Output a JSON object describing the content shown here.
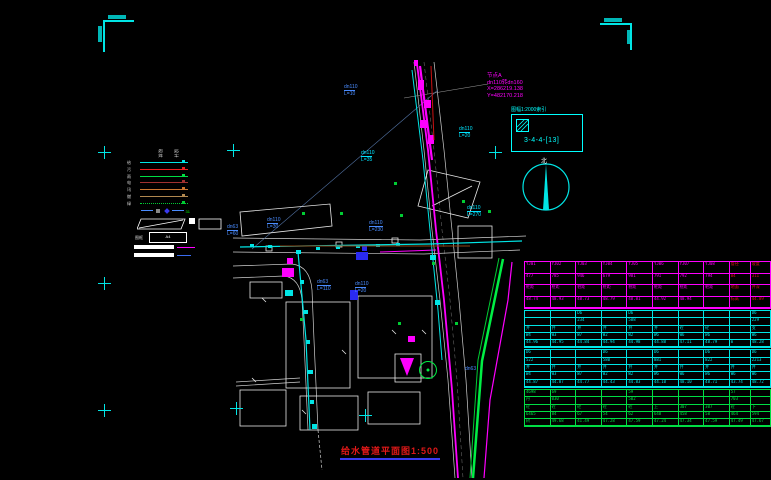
{
  "title": {
    "text": "给水管道平面图1:500"
  },
  "coord_note": {
    "l1": "节点A",
    "l2": "dn110转dn160",
    "l3": "X=286219.138",
    "l4": "Y=482170.218"
  },
  "detail_box": {
    "title": "图幅1:2000索引",
    "code": "3-4-4-[13]"
  },
  "north": {
    "label": "北"
  },
  "colors": {
    "magenta": "#ff00ff",
    "cyan": "#00ffff",
    "green": "#00ee44",
    "red": "#e01818",
    "blue": "#4a8cff",
    "white": "#ffffff"
  },
  "legend": {
    "headers": [
      "现状",
      "设计"
    ],
    "rows": [
      {
        "label": "给",
        "color": "#00e5e5",
        "style": "solid"
      },
      {
        "label": "污",
        "color": "#ee2222",
        "style": "solid"
      },
      {
        "label": "雨",
        "color": "#00dd44",
        "style": "solid"
      },
      {
        "label": "电",
        "color": "#a03030",
        "style": "solid"
      },
      {
        "label": "讯",
        "color": "#cc7630",
        "style": "solid"
      },
      {
        "label": "燃",
        "color": "#b08850",
        "style": "solid"
      },
      {
        "label": "绿",
        "color": "#00cc33",
        "style": "dotted"
      }
    ],
    "symbol_row": {
      "dash_color": "#4a8cff",
      "diamond_color": "#3a3af0",
      "square_color": "#888888",
      "note": "31"
    },
    "frame_label": "图框",
    "a4_label": "A4"
  },
  "annotations": [
    {
      "text": "dn110",
      "sub": "L=10",
      "x": 344,
      "y": 85,
      "color": "#4a8cff"
    },
    {
      "text": "dn110",
      "sub": "L=20",
      "x": 459,
      "y": 127,
      "color": "#00e5ff"
    },
    {
      "text": "dn110",
      "sub": "L=35",
      "x": 361,
      "y": 151,
      "color": "#00e5ff"
    },
    {
      "text": "dn63",
      "sub": "L=60",
      "x": 227,
      "y": 225,
      "color": "#4a8cff"
    },
    {
      "text": "dn110",
      "sub": "L=30",
      "x": 267,
      "y": 218,
      "color": "#4a8cff"
    },
    {
      "text": "dn110",
      "sub": "L=270",
      "x": 467,
      "y": 206,
      "color": "#00e5ff"
    },
    {
      "text": "dn63",
      "sub": "L=110",
      "x": 317,
      "y": 280,
      "color": "#4a8cff"
    },
    {
      "text": "dn110",
      "sub": "L=20",
      "x": 355,
      "y": 282,
      "color": "#4a8cff"
    },
    {
      "text": "dn110",
      "sub": "L=230",
      "x": 369,
      "y": 221,
      "color": "#4a8cff"
    },
    {
      "text": "dn63",
      "sub": "",
      "x": 465,
      "y": 367,
      "color": "#4a8cff"
    }
  ],
  "grid_crosses": [
    {
      "x": 104,
      "y": 152
    },
    {
      "x": 104,
      "y": 283
    },
    {
      "x": 104,
      "y": 410
    },
    {
      "x": 233,
      "y": 150
    },
    {
      "x": 495,
      "y": 152
    },
    {
      "x": 365,
      "y": 415
    },
    {
      "x": 236,
      "y": 408
    }
  ],
  "table": {
    "red": "#e01818",
    "sections": [
      {
        "color": "#ff00ff",
        "row_h": 11.5,
        "red_cols": [
          8,
          9
        ],
        "rows": [
          [
            "YJ01",
            "YJ02",
            "YJ03",
            "YJ04",
            "YJ05",
            "YJ06",
            "YJ07",
            "YJ08",
            "管径",
            "坡度"
          ],
          [
            "477",
            "785",
            "946",
            "679",
            "981",
            "791",
            "792",
            "794",
            "84",
            "311"
          ],
          [
            "桩距",
            "桩距",
            "桩距",
            "桩距",
            "桩距",
            "桩距",
            "桩距",
            "桩距",
            "地面",
            "井深"
          ],
          [
            "48.74",
            "48.93",
            "48.73",
            "48.79",
            "48.81",
            "44.92",
            "48.94",
            "",
            "标高",
            "44.89"
          ]
        ]
      },
      {
        "color": "#00e5e5",
        "row_h": 7.3,
        "red_cols": [],
        "rows": [
          [
            "",
            "",
            "D6",
            "",
            "D6",
            "",
            "",
            "",
            "",
            "D6"
          ],
          [
            "",
            "",
            "234",
            "",
            "588",
            "",
            "",
            "",
            "",
            "229"
          ],
          [
            "井",
            "井",
            "井",
            "井",
            "井",
            "井",
            "砼",
            "砼",
            "",
            "支"
          ],
          [
            "W4",
            "W3",
            "W7",
            "W2",
            "W2",
            "W6",
            "W6",
            "W6",
            "",
            "W6"
          ],
          [
            "44.96",
            "44.95",
            "44.84",
            "44.94",
            "44.98",
            "44.88",
            "47.11",
            "48.79",
            "m",
            "48.28"
          ]
        ]
      },
      {
        "color": "#00e5e5",
        "row_h": 7.3,
        "red_cols": [],
        "rows": [
          [
            "D6",
            "",
            "",
            "D6",
            "",
            "D6",
            "",
            "D6",
            "",
            "D6"
          ],
          [
            "522",
            "",
            "",
            "580",
            "",
            "881",
            "",
            "822",
            "",
            "2213"
          ],
          [
            "井",
            "井",
            "井",
            "井",
            "井",
            "井",
            "井",
            "井",
            "井",
            "井"
          ],
          [
            "W4",
            "W3",
            "W7",
            "W2",
            "W2",
            "W6",
            "W6",
            "W6",
            "W6",
            "W6"
          ],
          [
            "44.87",
            "44.87",
            "44.77",
            "44.43",
            "44.83",
            "44.10",
            "48.10",
            "48.71",
            "43.74",
            "48.72"
          ]
        ]
      },
      {
        "color": "#00dd44",
        "row_h": 7.3,
        "red_cols": [],
        "rows": [
          [
            "4698",
            "69",
            "",
            "",
            "59",
            "",
            "",
            "",
            "57",
            ""
          ],
          [
            "丹",
            "030",
            "",
            "",
            "502",
            "",
            "",
            "",
            "703",
            ""
          ],
          [
            "砼",
            "砼",
            "砼",
            "砼",
            "砼",
            "上",
            "307",
            "307",
            "砼",
            "下"
          ],
          [
            "6465",
            "84",
            "67",
            "54",
            "62",
            "648",
            "458",
            "58",
            "464",
            "594"
          ],
          [
            "树",
            "49.68",
            "41.49",
            "47.28",
            "47.59",
            "47.24",
            "47.34",
            "47.59",
            "47.49",
            "47.67"
          ]
        ]
      }
    ]
  }
}
